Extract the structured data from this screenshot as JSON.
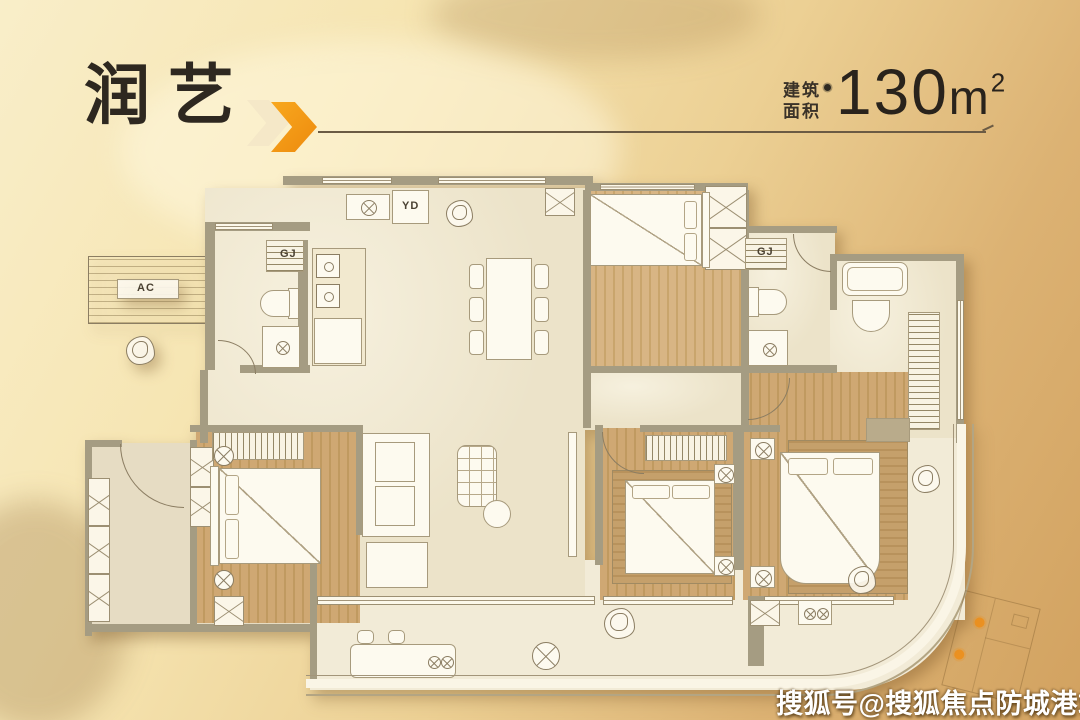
{
  "header": {
    "title": "润艺",
    "area_label_line1": "建筑",
    "area_label_line2": "面积",
    "area_value": "130",
    "area_unit": "m",
    "area_exponent": "2"
  },
  "plan_labels": {
    "flue": "YD",
    "shaft_left": "GJ",
    "shaft_right": "GJ",
    "ac_platform": "AC"
  },
  "watermark": "搜狐号@搜狐焦点防城港站",
  "colors": {
    "accent_orange": "#F59B1E",
    "chevron_cream": "#F5E8C8",
    "title_text": "#2E2820",
    "rule_line": "#6B5B44",
    "wall": "#A59C82",
    "wood_floor": "#C9A268",
    "marble_floor": "#ECE3C9",
    "background_light": "#F9EEC9",
    "background_dark": "#D2A260",
    "watermark_text": "#FFFFFF"
  }
}
